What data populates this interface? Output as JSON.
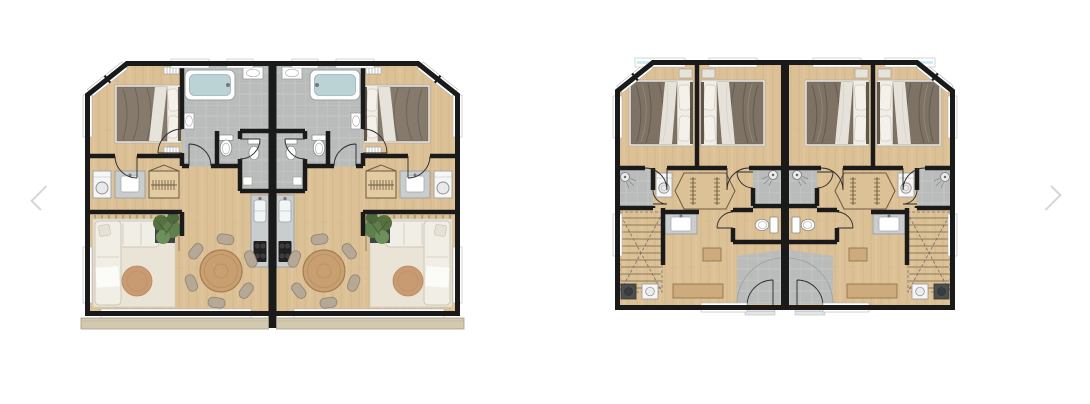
{
  "page": {
    "background_color": "#ffffff"
  },
  "carousel": {
    "prev": {
      "icon": "chevron-left-icon",
      "label": "Previous slide"
    },
    "next": {
      "icon": "chevron-right-icon",
      "label": "Next slide"
    }
  },
  "slides": [
    {
      "name": "living-floor-plan",
      "kind": "floor-plan-rendering"
    },
    {
      "name": "bedroom-floor-plan",
      "kind": "floor-plan-rendering"
    }
  ],
  "colors": {
    "background": "#ffffff",
    "arrow": "#d6d6d6",
    "wall": "#1a1a1a",
    "wood_floor": "#dcc096",
    "plank_line": "#cdb086",
    "tile": "#b9bcbb",
    "tile_grout": "#c8cbca",
    "window_glass": "#cdeaf2",
    "window_frame": "#ffffff",
    "bedding": "#7e7265",
    "pillow": "#f3f0e9",
    "sofa": "#f1eee6",
    "rug": "#eae4d7",
    "round_rug": "#c89b72",
    "plant": "#5f7f4c",
    "planter": "#3f4448",
    "table_wood": "#c79f70",
    "chair": "#b5a897",
    "counter": "#c9cdce",
    "appliance_dark": "#242424",
    "balcony": "#d2c9ae"
  }
}
